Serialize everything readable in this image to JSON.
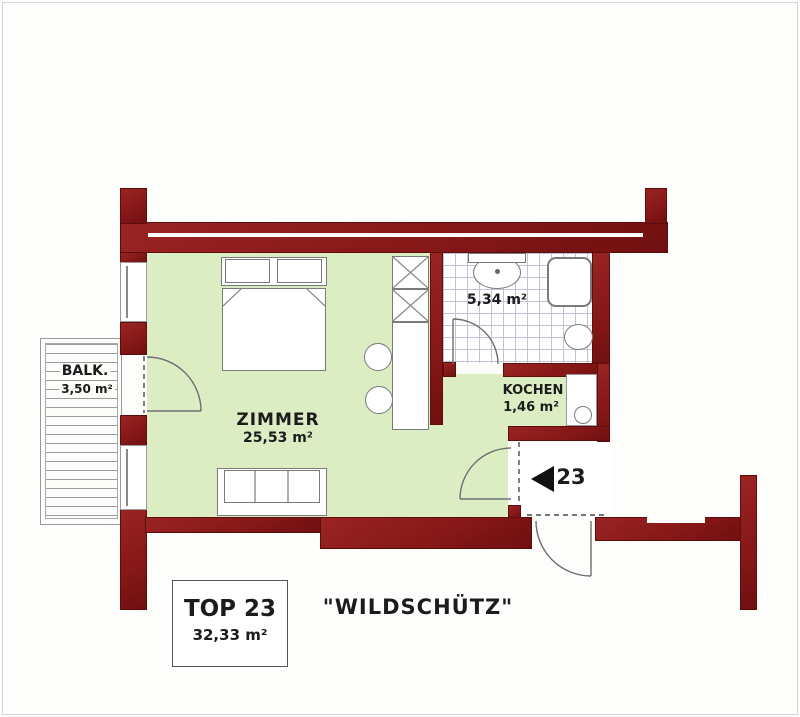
{
  "plan": {
    "unit_label": "TOP 23",
    "unit_area": "32,33 m²",
    "project_name": "\"WILDSCHÜTZ\"",
    "entry_number": "23",
    "rooms": {
      "zimmer": {
        "name": "ZIMMER",
        "area": "25,53 m²"
      },
      "kochen": {
        "name": "KOCHEN",
        "area": "1,46 m²"
      },
      "bad": {
        "area": "5,34 m²"
      },
      "balkon": {
        "name": "BALK.",
        "area": "3,50 m²"
      }
    },
    "colors": {
      "wall": "#8a1a1a",
      "floor": "#dcedc4",
      "tile_line": "#c2c2d4"
    }
  }
}
